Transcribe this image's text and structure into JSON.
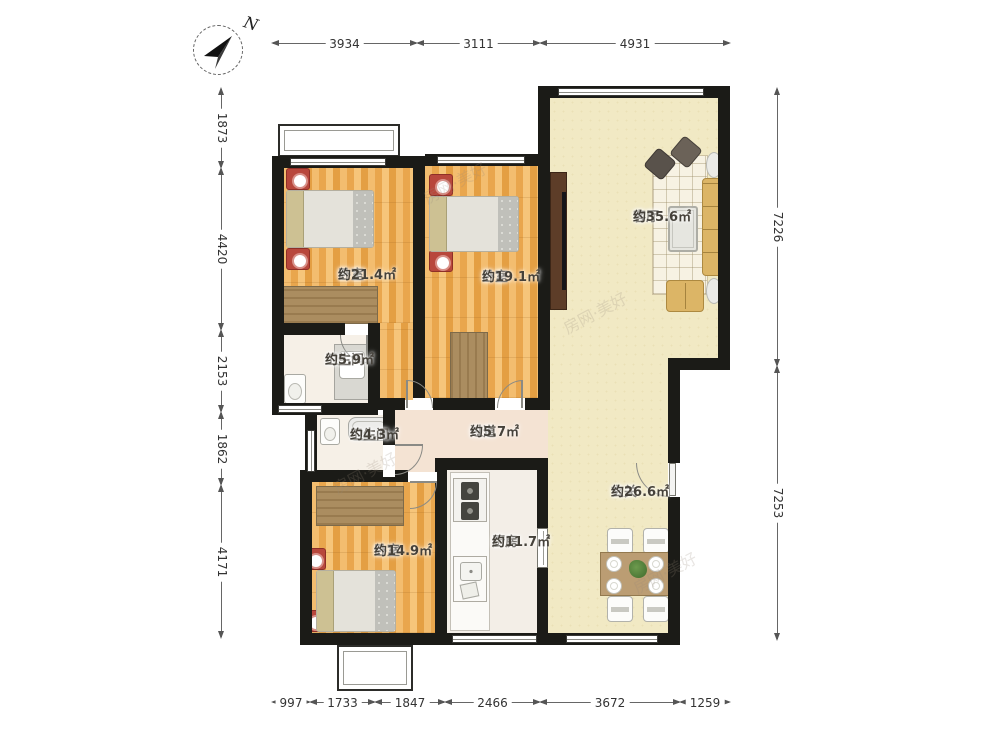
{
  "compass": {
    "north_label": "N"
  },
  "watermark": {
    "text": "房网·美好"
  },
  "palette": {
    "wall": "#1b1b17",
    "wood_floor": "#ecab54",
    "living_floor": "#f1e9c4",
    "hall_floor": "#f4e3d3",
    "nightstand_red": "#b8473c",
    "sofa_tan": "#dcb566",
    "wardrobe_brown": "#ab8d60"
  },
  "rooms": {
    "bedroom1": {
      "name": "卧室",
      "area": "约21.4㎡"
    },
    "bedroom2": {
      "name": "卧室",
      "area": "约19.1㎡"
    },
    "living": {
      "name": "客厅",
      "area": "约35.6㎡"
    },
    "bath1": {
      "name": "卫生间",
      "area": "约5.9㎡"
    },
    "bath2": {
      "name": "卫生间",
      "area": "约4.3㎡"
    },
    "hallway": {
      "name": "过道",
      "area": "约5.7㎡"
    },
    "entry": {
      "name": "玄关",
      "area": "约26.6㎡"
    },
    "bedroom3": {
      "name": "卧室",
      "area": "约14.9㎡"
    },
    "kitchen": {
      "name": "厨房",
      "area": "约11.7㎡"
    }
  },
  "dimensions": {
    "top": {
      "y": 38,
      "segments": [
        {
          "label": "3934",
          "from": 272,
          "to": 417
        },
        {
          "label": "3111",
          "from": 417,
          "to": 540
        },
        {
          "label": "4931",
          "from": 540,
          "to": 730
        }
      ]
    },
    "bottom": {
      "y": 697,
      "segments": [
        {
          "label": "997",
          "from": 272,
          "to": 310
        },
        {
          "label": "1733",
          "from": 310,
          "to": 375
        },
        {
          "label": "1847",
          "from": 375,
          "to": 445
        },
        {
          "label": "2466",
          "from": 445,
          "to": 540
        },
        {
          "label": "3672",
          "from": 540,
          "to": 680
        },
        {
          "label": "1259",
          "from": 680,
          "to": 730
        }
      ]
    },
    "left": {
      "x": 216,
      "segments": [
        {
          "label": "1873",
          "from": 88,
          "to": 168
        },
        {
          "label": "4420",
          "from": 168,
          "to": 330
        },
        {
          "label": "2153",
          "from": 330,
          "to": 412
        },
        {
          "label": "1862",
          "from": 412,
          "to": 485
        },
        {
          "label": "4171",
          "from": 485,
          "to": 638
        }
      ]
    },
    "right": {
      "x": 772,
      "segments": [
        {
          "label": "7226",
          "from": 88,
          "to": 366
        },
        {
          "label": "7253",
          "from": 366,
          "to": 640
        }
      ]
    }
  }
}
